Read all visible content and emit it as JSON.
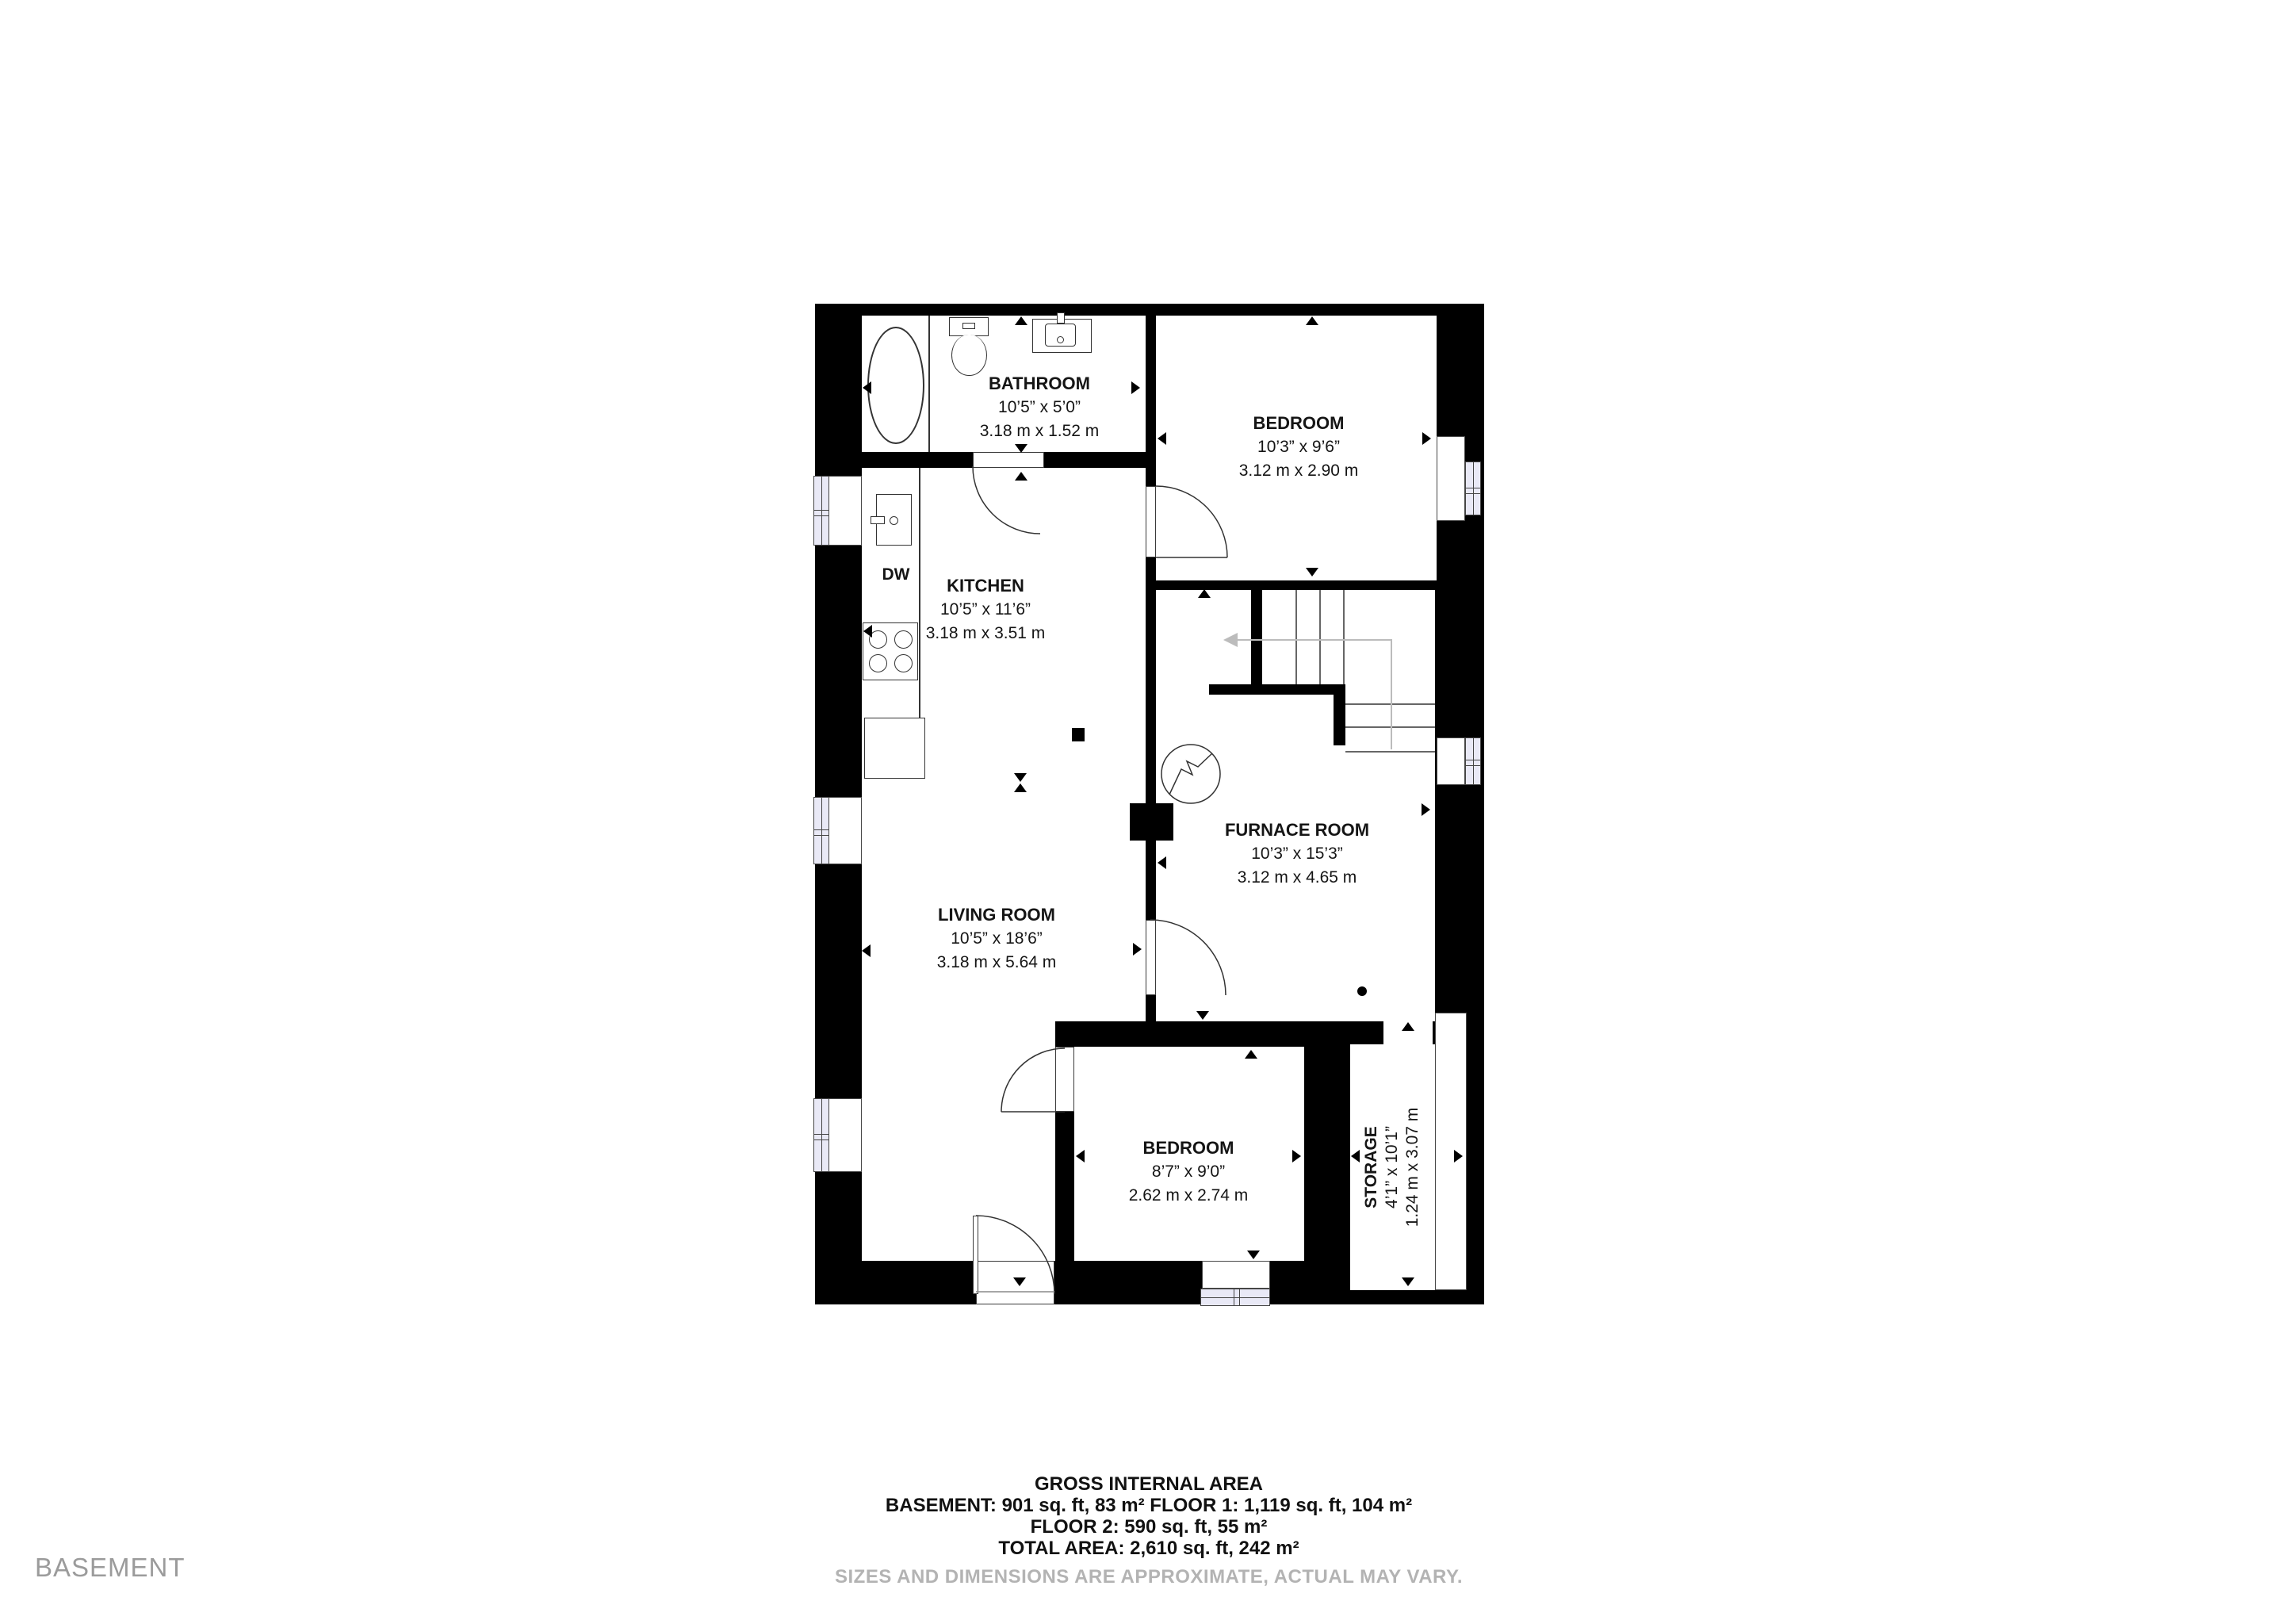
{
  "floor_label": "BASEMENT",
  "plan": {
    "rooms": {
      "bathroom": {
        "name": "BATHROOM",
        "imperial": "10’5” x 5’0”",
        "metric": "3.18 m x 1.52 m"
      },
      "bedroom_top": {
        "name": "BEDROOM",
        "imperial": "10’3” x 9’6”",
        "metric": "3.12 m x 2.90 m"
      },
      "kitchen": {
        "name": "KITCHEN",
        "imperial": "10’5” x 11’6”",
        "metric": "3.18 m x 3.51 m"
      },
      "living_room": {
        "name": "LIVING ROOM",
        "imperial": "10’5” x 18’6”",
        "metric": "3.18 m x 5.64 m"
      },
      "furnace_room": {
        "name": "FURNACE ROOM",
        "imperial": "10’3” x 15’3”",
        "metric": "3.12 m x 4.65 m"
      },
      "bedroom_bottom": {
        "name": "BEDROOM",
        "imperial": "8’7” x 9’0”",
        "metric": "2.62 m x 2.74 m"
      },
      "storage": {
        "name": "STORAGE",
        "imperial": "4’1” x 10’1”",
        "metric": "1.24 m x 3.07 m"
      }
    },
    "appliances": {
      "dishwasher": "DW"
    }
  },
  "footer": {
    "title": "GROSS INTERNAL AREA",
    "lines": [
      "BASEMENT: 901 sq. ft, 83 m² FLOOR 1: 1,119 sq. ft, 104 m²",
      "FLOOR 2: 590 sq. ft, 55 m²",
      "TOTAL AREA: 2,610 sq. ft, 242 m²"
    ],
    "disclaimer": "SIZES AND DIMENSIONS ARE APPROXIMATE, ACTUAL MAY VARY."
  },
  "colors": {
    "wall": "#000000",
    "window_glass": "#e9e9f6",
    "muted_text": "#9b9b9b",
    "stair_guide": "#bcbcbc"
  }
}
